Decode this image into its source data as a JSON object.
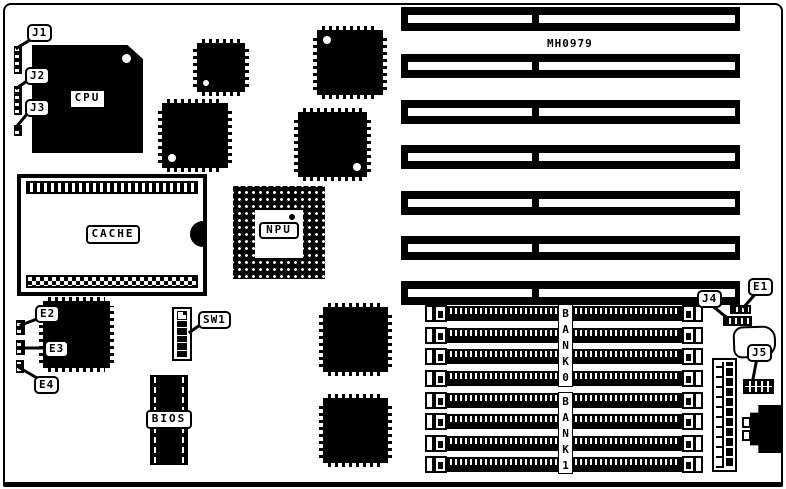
{
  "board": {
    "id": "MH0979",
    "description": "motherboard layout diagram"
  },
  "colors": {
    "ink": "#000000",
    "paper": "#ffffff"
  },
  "chips": {
    "cpu_label": "CPU",
    "cache_label": "CACHE",
    "npu_label": "NPU",
    "bios_label": "BIOS"
  },
  "callouts": {
    "j1": "J1",
    "j2": "J2",
    "j3": "J3",
    "j4": "J4",
    "j5": "J5",
    "e1": "E1",
    "e2": "E2",
    "e3": "E3",
    "e4": "E4",
    "sw1": "SW1"
  },
  "memory": {
    "bank0_label": "BANK0",
    "bank1_label": "BANK1",
    "simm_slot_count": 8
  },
  "expansion": {
    "isa_slot_count": 7
  }
}
